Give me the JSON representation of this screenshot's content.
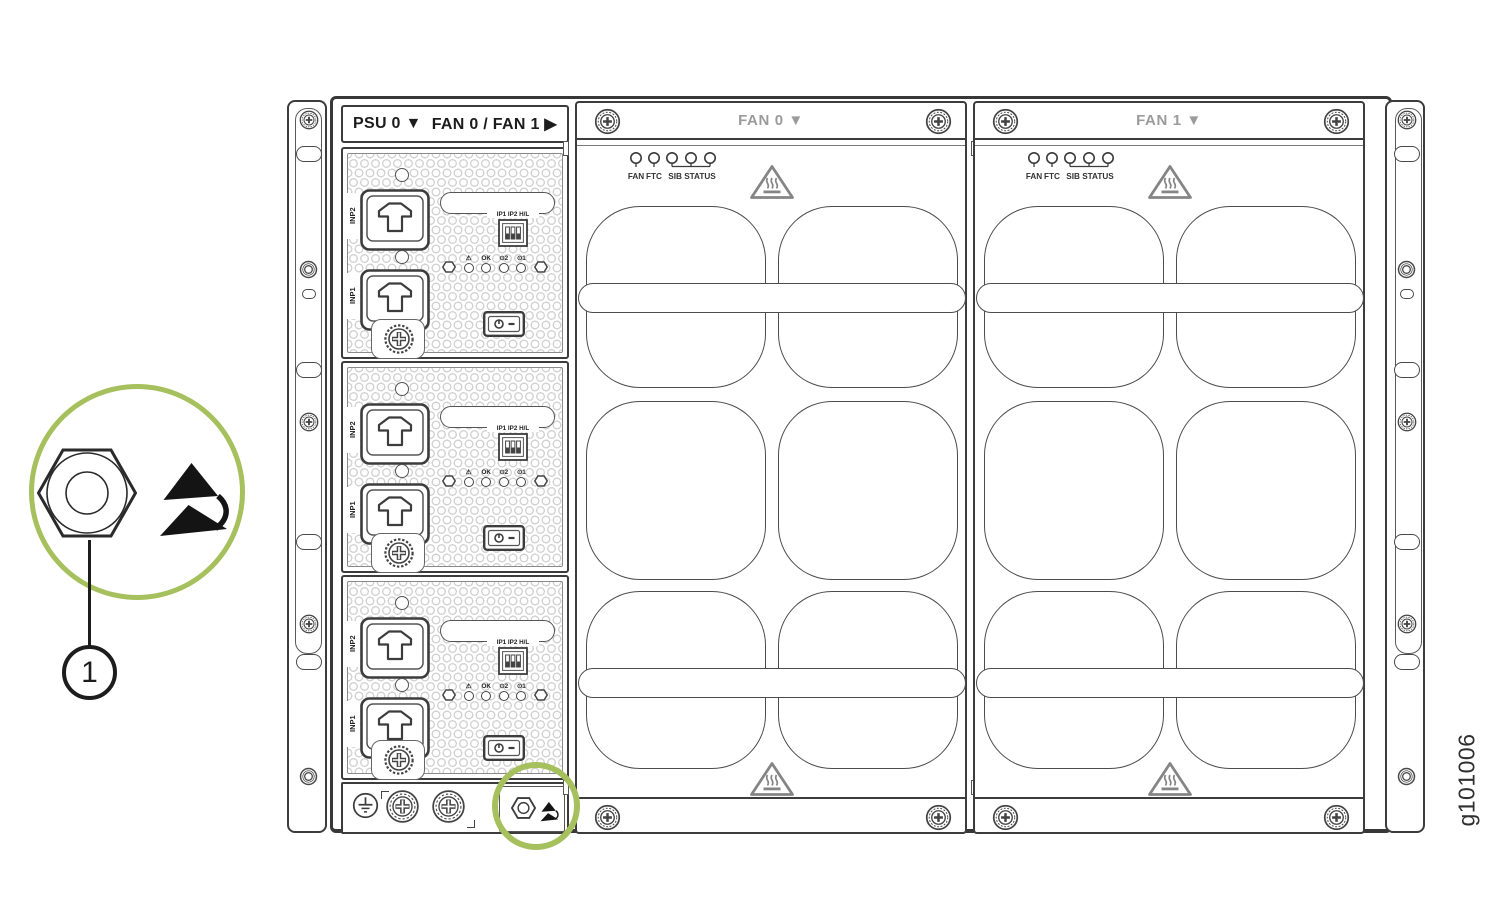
{
  "figure": {
    "code": "g101006"
  },
  "callout": {
    "number": "1"
  },
  "colors": {
    "highlight_green": "#a5c05d",
    "line_dark": "#3c3c3c",
    "title_gray": "#9b9b9b"
  },
  "psu_section": {
    "header_left": "PSU 0 ▼",
    "header_right": "FAN 0 / FAN 1 ▶",
    "module_labels": {
      "inp2": "INP2",
      "inp1": "INP1",
      "dip": "IP1 IP2 H/L",
      "led_warning": "⚠",
      "led_ok": "OK",
      "led_in2": "⊙2",
      "led_in1": "⊙1"
    }
  },
  "fan_trays": {
    "fan0_title": "FAN 0 ▼",
    "fan1_title": "FAN 1 ▼",
    "led_fan": "FAN",
    "led_ftc": "FTC",
    "led_sib": "SIB STATUS"
  }
}
